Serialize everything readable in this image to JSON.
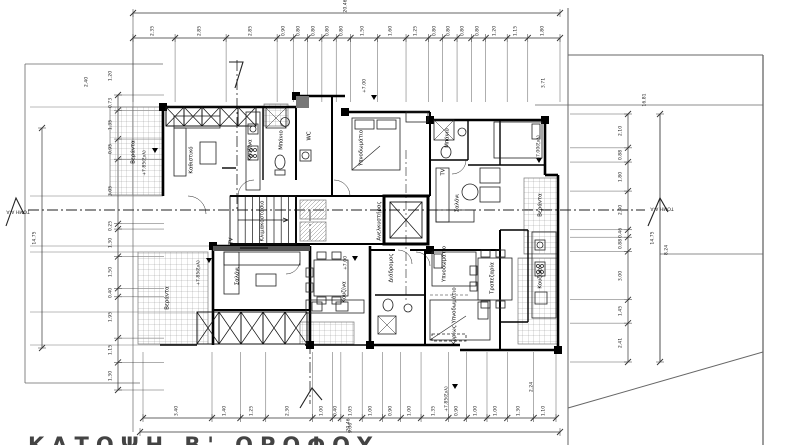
{
  "drawing": {
    "title": "ΚΑΤΟΨΗ Β' ΟΡΟΦΟΥ",
    "section_label": "ΤΟΜΗ Α-Α",
    "line_color": "#1a1a1a",
    "hatch_color": "#999999"
  },
  "dims": {
    "top_overall": "20.46",
    "top": [
      "2.35",
      "2.85",
      "2.85",
      "0.90",
      "0.80",
      "0.80",
      "0.80",
      "0.80",
      "1.50",
      "1.60",
      "1.25",
      "0.80",
      "0.80",
      "0.80",
      "0.80",
      "1.20",
      "1.15",
      "1.80"
    ],
    "bottom": [
      "3.40",
      "1.40",
      "1.25",
      "2.30",
      "1.00",
      "0.40",
      "1.05",
      "1.00",
      "0.90",
      "1.00",
      "1.35",
      "0.90",
      "1.00",
      "1.00",
      "1.30",
      "1.10"
    ],
    "bottom_overall": "20.46",
    "left": [
      "0.73",
      "1.35",
      "0.95",
      "3.05",
      "0.25",
      "1.30",
      "1.50",
      "0.40",
      "1.95",
      "1.15",
      "1.30"
    ],
    "left_overall": "14.75",
    "right": [
      "2.10",
      "0.88",
      "1.80",
      "2.40",
      "0.46",
      "0.88",
      "3.00",
      "1.45",
      "2.41"
    ],
    "right_overall": "14.75",
    "right_offset": "8.24",
    "site_top": "16.81",
    "misc": [
      {
        "t": "3.71",
        "x": 545,
        "y": 83
      },
      {
        "t": "2.24",
        "x": 533,
        "y": 387
      },
      {
        "t": "1.20",
        "x": 112,
        "y": 76
      },
      {
        "t": "2.40",
        "x": 88,
        "y": 82
      },
      {
        "t": "9.06",
        "x": 352,
        "y": 428
      }
    ]
  },
  "rooms": [
    {
      "t": "Βεράντα",
      "x": 134,
      "y": 152
    },
    {
      "t": "Καθιστικό",
      "x": 192,
      "y": 160
    },
    {
      "t": "Κουζίνα",
      "x": 251,
      "y": 150
    },
    {
      "t": "Μπάνιο",
      "x": 282,
      "y": 140
    },
    {
      "t": "Υπνοδωμάτιο",
      "x": 362,
      "y": 148
    },
    {
      "t": "Μπάνιο",
      "x": 448,
      "y": 138
    },
    {
      "t": "Σαλόνι",
      "x": 458,
      "y": 203
    },
    {
      "t": "Βεράντα",
      "x": 541,
      "y": 205
    },
    {
      "t": "Τραπεζαρία",
      "x": 493,
      "y": 278
    },
    {
      "t": "Κουζίνα",
      "x": 541,
      "y": 278
    },
    {
      "t": "Σαλόνι",
      "x": 238,
      "y": 276
    },
    {
      "t": "Βεράντα",
      "x": 168,
      "y": 298
    },
    {
      "t": "Κουζίνα",
      "x": 345,
      "y": 292
    },
    {
      "t": "Υπνοδωμάτιο",
      "x": 445,
      "y": 264
    },
    {
      "t": "Κυρίως Υπνοδωμάτιο",
      "x": 455,
      "y": 316
    },
    {
      "t": "Διάδρομος",
      "x": 392,
      "y": 268
    },
    {
      "t": "Κλιμακοστάσιο",
      "x": 263,
      "y": 221
    },
    {
      "t": "Ανελκυστήρας",
      "x": 380,
      "y": 221
    },
    {
      "t": "TV",
      "x": 232,
      "y": 241
    },
    {
      "t": "TV",
      "x": 444,
      "y": 172
    },
    {
      "t": "WC",
      "x": 310,
      "y": 136
    }
  ],
  "elevations": [
    {
      "t": "+7.85(ξυλ)",
      "x": 146,
      "y": 163
    },
    {
      "t": "+7.85(ξυλ)",
      "x": 200,
      "y": 273
    },
    {
      "t": "+7.00",
      "x": 366,
      "y": 86
    },
    {
      "t": "+7.00",
      "x": 347,
      "y": 263
    },
    {
      "t": "+7.85(ξυλ)",
      "x": 448,
      "y": 399
    },
    {
      "t": "+7.00(ξυλ)",
      "x": 540,
      "y": 148
    }
  ],
  "sections": [
    {
      "t": "ΤΟΜΗ Α-Α",
      "x": 18,
      "y": 210,
      "r": 180
    },
    {
      "t": "ΤΟΜΗ Α-Α",
      "x": 662,
      "y": 207,
      "r": 180
    }
  ]
}
